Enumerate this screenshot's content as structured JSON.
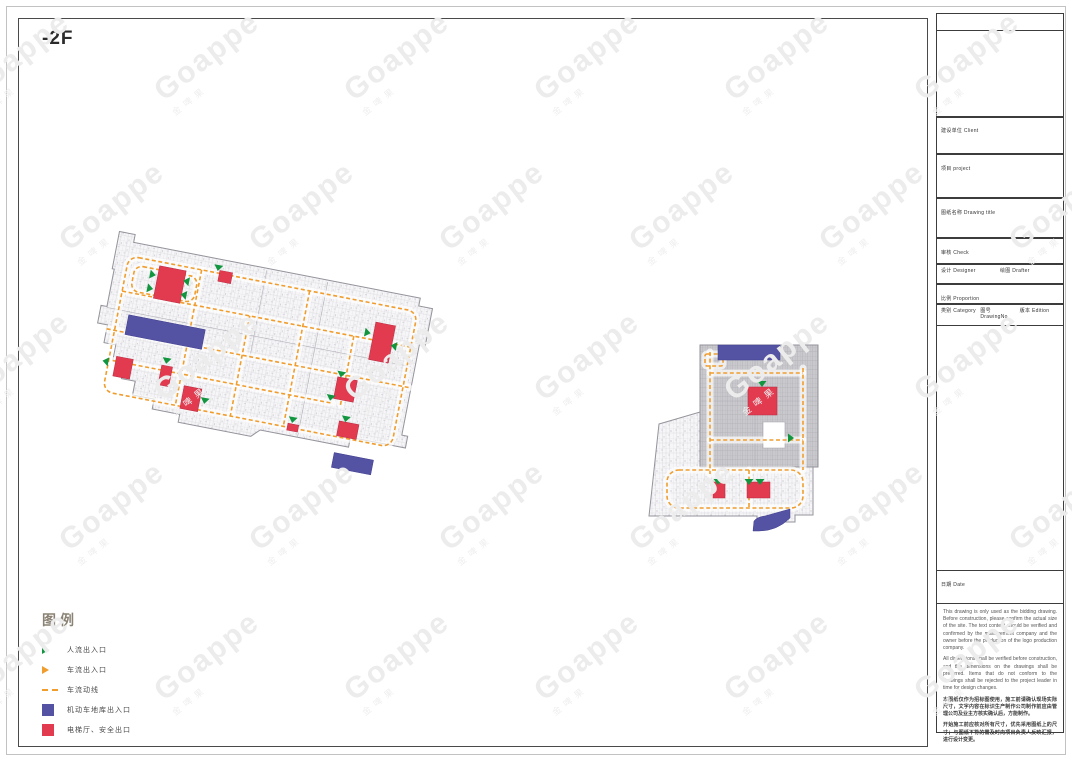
{
  "sheet": {
    "floor_label": "-2F",
    "watermark_brand": "Goappe",
    "watermark_cjk": "金啤果"
  },
  "legend": {
    "title": "图例",
    "items": [
      {
        "swatch": "triangle",
        "color": "#12953f",
        "label": "人流出入口"
      },
      {
        "swatch": "triangle",
        "color": "#f09d2e",
        "label": "车流出入口"
      },
      {
        "swatch": "dash",
        "color": "#f09d2e",
        "label": "车流动线"
      },
      {
        "swatch": "square",
        "color": "#5452a3",
        "label": "机动车地库出入口"
      },
      {
        "swatch": "square",
        "color": "#e23b50",
        "label": "电梯厅、安全出口"
      }
    ]
  },
  "titleblock": {
    "client_label": "建设单位 Client",
    "project_label": "项目 project",
    "drawing_title_label": "图纸名称 Drawing title",
    "check_label": "审核 Check",
    "designer_label": "设计 Designer",
    "drafter_label": "绘图 Drafter",
    "proportion_label": "比例 Proportion",
    "category_label": "类别 Category",
    "drawing_no_label": "图号 DrawingNo",
    "edition_label": "版本 Edition",
    "date_label": "日期 Date",
    "notes_en_1": "This drawing is only used as the bidding drawing. Before construction, please confirm the actual size of the site. The text content should be verified and confirmed by the management company and the owner before the production of the logo production company.",
    "notes_en_2": "All dimensions shall be verified before construction, and the dimensions on the drawings shall be preferred. Items that do not conform to the drawings shall be rejected to the project leader in time for design changes.",
    "notes_cn_1": "本图纸仅作为招标图使用，施工前请确认现场实际尺寸，文字内容在标识生产制作公司制作前应由管理公司及业主方核实确认后，方能制作。",
    "notes_cn_2": "开始施工前应核对所有尺寸，优先采用图纸上的尺寸；与图纸不符的需及时向项目负责人反映汇报，进行设计变更。"
  },
  "plans": {
    "left": {
      "transform": "translate(112,228) rotate(11)",
      "regions": [
        {
          "class": "light",
          "path": "M8,12 L8,2 L24,2 L24,10 L316,10 L316,18 L330,18 L330,56 L324,56 L324,148 L330,148 L330,160 L274,160 L274,170 L184,170 L176,178 L102,178 L102,170 L74,170 L74,160 L52,160 L52,146 L38,146 L38,130 L26,130 L26,114 L14,114 L14,96 L4,96 L4,78 L10,78 L10,40 L8,40 Z"
        }
      ],
      "walls": [
        [
          10,
          79,
          320,
          79
        ],
        [
          222,
          12,
          222,
          170
        ],
        [
          160,
          12,
          160,
          100
        ]
      ],
      "routes": [
        {
          "kind": "rect",
          "x": 22,
          "y": 24,
          "w": 294,
          "h": 138,
          "r": 10
        },
        {
          "kind": "rect",
          "x": 30,
          "y": 32,
          "w": 64,
          "h": 26,
          "r": 8
        },
        {
          "kind": "line",
          "x1": 22,
          "y1": 60,
          "x2": 316,
          "y2": 60
        },
        {
          "kind": "line",
          "x1": 14,
          "y1": 100,
          "x2": 322,
          "y2": 100
        },
        {
          "kind": "line",
          "x1": 26,
          "y1": 130,
          "x2": 250,
          "y2": 130
        },
        {
          "kind": "line",
          "x1": 96,
          "y1": 24,
          "x2": 96,
          "y2": 162
        },
        {
          "kind": "line",
          "x1": 152,
          "y1": 60,
          "x2": 152,
          "y2": 162
        },
        {
          "kind": "line",
          "x1": 206,
          "y1": 24,
          "x2": 206,
          "y2": 162
        },
        {
          "kind": "line",
          "x1": 258,
          "y1": 60,
          "x2": 258,
          "y2": 130
        }
      ],
      "red_boxes": [
        [
          54,
          28,
          27,
          33
        ],
        [
          114,
          21,
          13,
          11
        ],
        [
          277,
          42,
          20,
          38
        ],
        [
          29,
          125,
          17,
          20
        ],
        [
          75,
          125,
          11,
          20
        ],
        [
          101,
          141,
          18,
          23
        ],
        [
          250,
          103,
          20,
          22
        ],
        [
          210,
          158,
          11,
          7
        ],
        [
          260,
          146,
          20,
          15
        ]
      ],
      "blue_boxes": [
        [
          33,
          82,
          78,
          20
        ],
        [
          261,
          178,
          40,
          15
        ]
      ],
      "blue_paths": [],
      "green_arrows": [
        [
          46,
          38,
          "e"
        ],
        [
          46,
          52,
          "e"
        ],
        [
          86,
          38,
          "w"
        ],
        [
          86,
          52,
          "w"
        ],
        [
          112,
          16,
          "s"
        ],
        [
          268,
          54,
          "e"
        ],
        [
          302,
          62,
          "w"
        ],
        [
          22,
          132,
          "w"
        ],
        [
          79,
          117,
          "s"
        ],
        [
          124,
          149,
          "s"
        ],
        [
          253,
          97,
          "s"
        ],
        [
          247,
          122,
          "s"
        ],
        [
          214,
          151,
          "s"
        ],
        [
          266,
          140,
          "s"
        ]
      ]
    },
    "right": {
      "transform": "translate(645,338)",
      "regions": [
        {
          "class": "dark",
          "path": "M55,7 L173,7 L173,129 L55,129 Z"
        },
        {
          "class": "light",
          "path": "M14,86 L55,74 L55,129 L168,129 L168,177 L150,177 L150,184 L112,184 L112,178 L4,178 Z"
        },
        {
          "class": "white",
          "path": "M118,84 L140,84 L140,110 L118,110 Z"
        }
      ],
      "walls": [
        [
          55,
          63,
          173,
          63
        ],
        [
          110,
          7,
          110,
          129
        ]
      ],
      "routes": [
        {
          "kind": "rect",
          "x": 22,
          "y": 132,
          "w": 136,
          "h": 38,
          "r": 12
        },
        {
          "kind": "rect",
          "x": 60,
          "y": 16,
          "w": 18,
          "h": 12,
          "r": 2
        },
        {
          "kind": "line",
          "x1": 65,
          "y1": 14,
          "x2": 65,
          "y2": 136
        },
        {
          "kind": "line",
          "x1": 158,
          "y1": 30,
          "x2": 158,
          "y2": 132
        },
        {
          "kind": "line",
          "x1": 65,
          "y1": 35,
          "x2": 158,
          "y2": 35
        },
        {
          "kind": "line",
          "x1": 65,
          "y1": 102,
          "x2": 158,
          "y2": 102
        },
        {
          "kind": "line",
          "x1": 104,
          "y1": 132,
          "x2": 104,
          "y2": 170
        }
      ],
      "red_boxes": [
        [
          103,
          49,
          29,
          28
        ],
        [
          68,
          144,
          12,
          16
        ],
        [
          102,
          144,
          23,
          16
        ]
      ],
      "blue_boxes": [
        [
          73,
          7,
          62,
          15
        ]
      ],
      "blue_paths": [
        "M108,193 L109,183 Q112,179 120,178 L145,171 L145,180 Q132,193 114,193 Z"
      ],
      "green_arrows": [
        [
          117,
          43,
          "s"
        ],
        [
          143,
          100,
          "e"
        ],
        [
          73,
          141,
          "s"
        ],
        [
          104,
          141,
          "s"
        ],
        [
          115,
          141,
          "s"
        ]
      ]
    }
  }
}
